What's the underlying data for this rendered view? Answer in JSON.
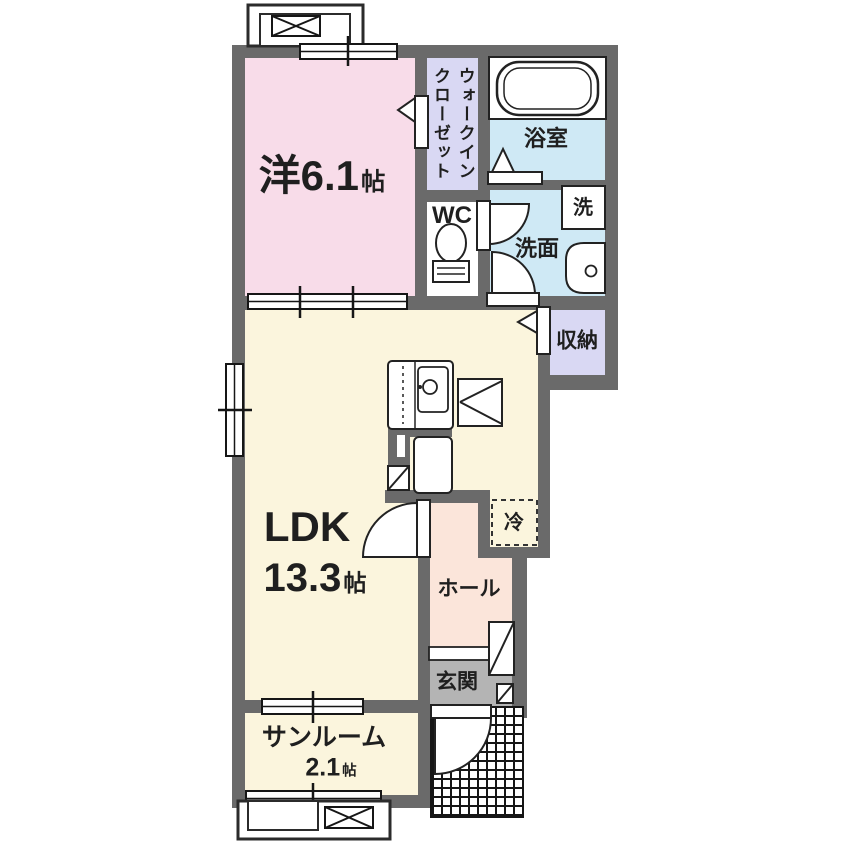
{
  "rooms": {
    "western": {
      "name": "洋6.1",
      "unit": "帖"
    },
    "wic": {
      "line1": "ウォークイン",
      "line2": "クローゼット"
    },
    "bath": {
      "name": "浴室"
    },
    "washer": {
      "name": "洗"
    },
    "washroom": {
      "name": "洗面"
    },
    "wc": {
      "name": "WC"
    },
    "storage": {
      "name": "収納"
    },
    "ldk": {
      "name": "LDK",
      "size": "13.3",
      "unit": "帖"
    },
    "fridge": {
      "name": "冷"
    },
    "hall": {
      "name": "ホール"
    },
    "entrance": {
      "name": "玄関"
    },
    "sunroom": {
      "name": "サンルーム",
      "size": "2.1",
      "unit": "帖"
    }
  },
  "colors": {
    "wall": "#6a6a6a",
    "western_room": "#f8dce9",
    "closet": "#d9d8f3",
    "wet_area": "#cfe9f5",
    "ldk": "#fbf5dd",
    "hall": "#fbe5da",
    "entrance_floor": "#b4b4b4",
    "line": "#1f1f1f"
  }
}
